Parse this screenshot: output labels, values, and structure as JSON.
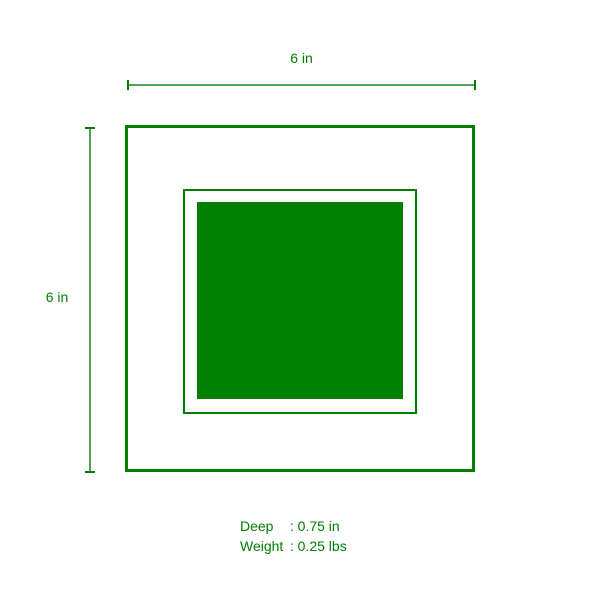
{
  "diagram": {
    "dimensions": {
      "width": {
        "label": "6 in"
      },
      "height": {
        "label": "6 in"
      }
    },
    "specs": {
      "rows": [
        {
          "label": "Deep",
          "value": ": 0.75 in"
        },
        {
          "label": "Weight",
          "value": ": 0.25 lbs"
        }
      ]
    },
    "colors": {
      "primary_green": "#008000",
      "dimension_line_green": "#55a055",
      "background": "#ffffff"
    }
  }
}
